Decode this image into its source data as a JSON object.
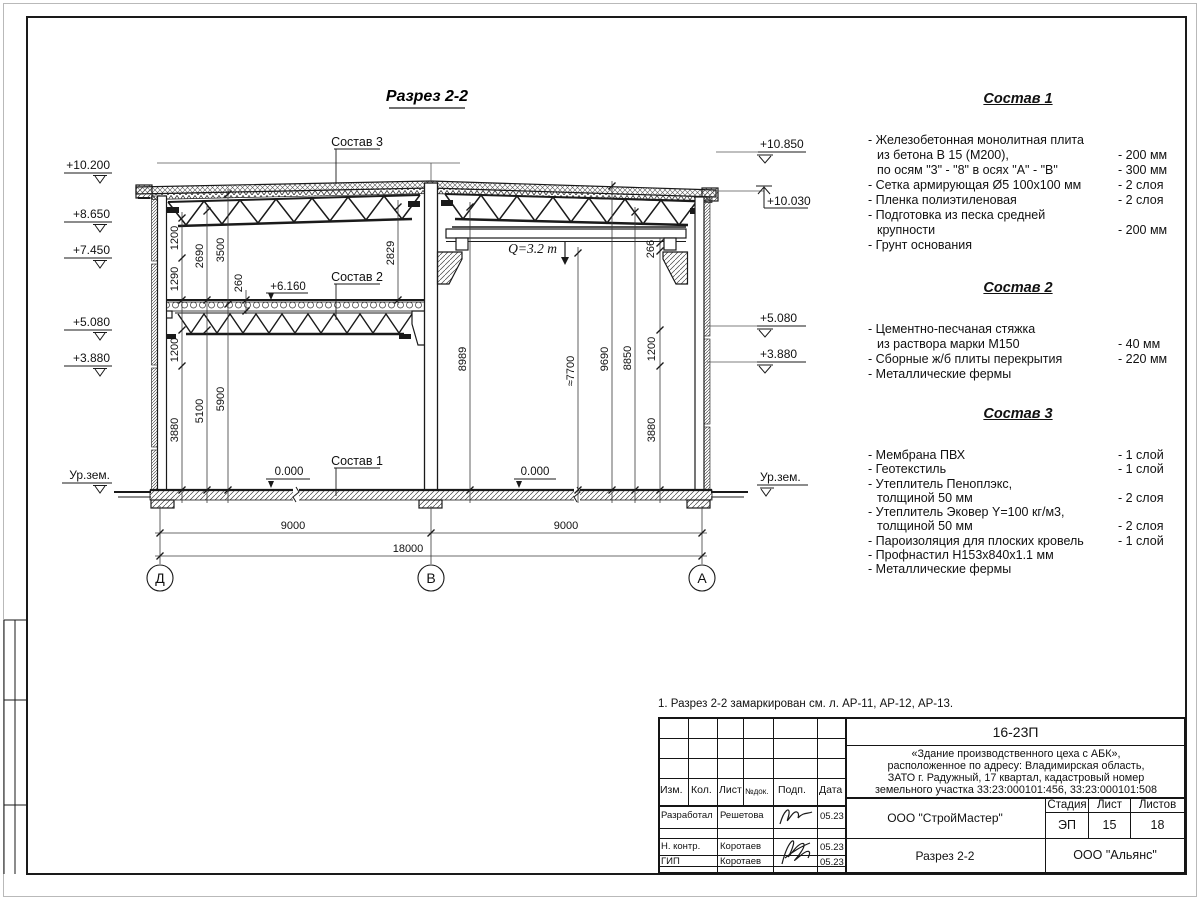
{
  "sheet": {
    "title": "Разрез 2-2",
    "note": "1. Разрез 2-2 замаркирован см. л. АР-11, АР-12, АР-13."
  },
  "drawing": {
    "crane_label": "Q=3.2 т",
    "refs": {
      "comp1": "Состав 1",
      "comp2": "Состав 2",
      "comp3": "Состав 3",
      "lvl_6160": "+6.160",
      "lvl_0_left": "0.000",
      "lvl_0_right": "0.000"
    },
    "elevations_left": {
      "e10200": "+10.200",
      "e8650": "+8.650",
      "e7450": "+7.450",
      "e5080": "+5.080",
      "e3880": "+3.880",
      "ground": "Ур.зем."
    },
    "elevations_right": {
      "e10850": "+10.850",
      "e10030": "+10.030",
      "e5080": "+5.080",
      "e3880": "+3.880",
      "ground": "Ур.зем."
    },
    "dims_left": {
      "d1200_top": "1200",
      "d1290": "1290",
      "d2690": "2690",
      "d3500": "3500",
      "d260": "260",
      "d2829": "2829",
      "d1200_low": "1200",
      "d5100": "5100",
      "d5900": "5900",
      "d3880": "3880"
    },
    "dims_right": {
      "d266": "266",
      "d8989": "8989",
      "d7700": "≈7700",
      "d9690": "9690",
      "d8850": "8850",
      "d1200": "1200",
      "d3880": "3880"
    },
    "dims_bottom": {
      "span_left": "9000",
      "span_right": "9000",
      "total": "18000"
    },
    "axes": {
      "left": "Д",
      "middle": "В",
      "right": "А"
    }
  },
  "compositions": {
    "comp1": {
      "title": "Состав 1",
      "rows": [
        {
          "label": "- Железобетонная  монолитная плита",
          "value": ""
        },
        {
          "label": "из бетона В 15 (М200),",
          "value": "- 200 мм"
        },
        {
          "label": "по осям \"3\" - \"8\" в осях \"А\" - \"В\"",
          "value": "- 300 мм"
        },
        {
          "label": "- Сетка армирующая Ø5 100х100 мм",
          "value": "- 2 слоя"
        },
        {
          "label": "- Пленка полиэтиленовая",
          "value": "- 2 слоя"
        },
        {
          "label": "- Подготовка из песка средней",
          "value": ""
        },
        {
          "label": "крупности",
          "value": "- 200 мм"
        },
        {
          "label": "- Грунт основания",
          "value": ""
        }
      ]
    },
    "comp2": {
      "title": "Состав 2",
      "rows": [
        {
          "label": "- Цементно-песчаная стяжка",
          "value": ""
        },
        {
          "label": "из раствора марки М150",
          "value": "- 40 мм"
        },
        {
          "label": "- Сборные ж/б плиты перекрытия",
          "value": "- 220 мм"
        },
        {
          "label": "- Металлические фермы",
          "value": ""
        }
      ]
    },
    "comp3": {
      "title": "Состав 3",
      "rows": [
        {
          "label": "- Мембрана ПВХ",
          "value": "- 1 слой"
        },
        {
          "label": "- Геотекстиль",
          "value": "- 1 слой"
        },
        {
          "label": "- Утеплитель Пеноплэкс,",
          "value": ""
        },
        {
          "label": "толщиной 50 мм",
          "value": "- 2 слоя"
        },
        {
          "label": "- Утеплитель Эковер Y=100 кг/м3,",
          "value": ""
        },
        {
          "label": "толщиной 50 мм",
          "value": "- 2 слоя"
        },
        {
          "label": "- Пароизоляция для плоских кровель",
          "value": "- 1 слой"
        },
        {
          "label": "- Профнастил Н153х840х1.1 мм",
          "value": ""
        },
        {
          "label": "- Металлические фермы",
          "value": ""
        }
      ]
    }
  },
  "titleblock": {
    "doc_code": "16-23П",
    "project_lines": {
      "l1": "«Здание производственного цеха с АБК»,",
      "l2": "расположенное по адресу: Владимирская область,",
      "l3": "ЗАТО г. Радужный, 17 квартал, кадастровый номер",
      "l4": "земельного участка 33:23:000101:456, 33:23:000101:508"
    },
    "columns": {
      "izm": "Изм.",
      "kol": "Кол.",
      "list": "Лист",
      "ndok": "№док.",
      "podp": "Подп.",
      "data": "Дата"
    },
    "rows": {
      "r1": {
        "role": "Разработал",
        "name": "Решетова",
        "date": "05.23"
      },
      "r2": {
        "role": "Н. контр.",
        "name": "Коротаев",
        "date": "05.23"
      },
      "r3": {
        "role": "ГИП",
        "name": "Коротаев",
        "date": "05.23"
      }
    },
    "designer_org": "ООО \"СтройМастер\"",
    "section_name": "Разрез 2-2",
    "client_org": "ООО \"Альянс\"",
    "stage": {
      "label": "Стадия",
      "value": "ЭП"
    },
    "sheet_no": {
      "label": "Лист",
      "value": "15"
    },
    "sheets_total": {
      "label": "Листов",
      "value": "18"
    }
  }
}
